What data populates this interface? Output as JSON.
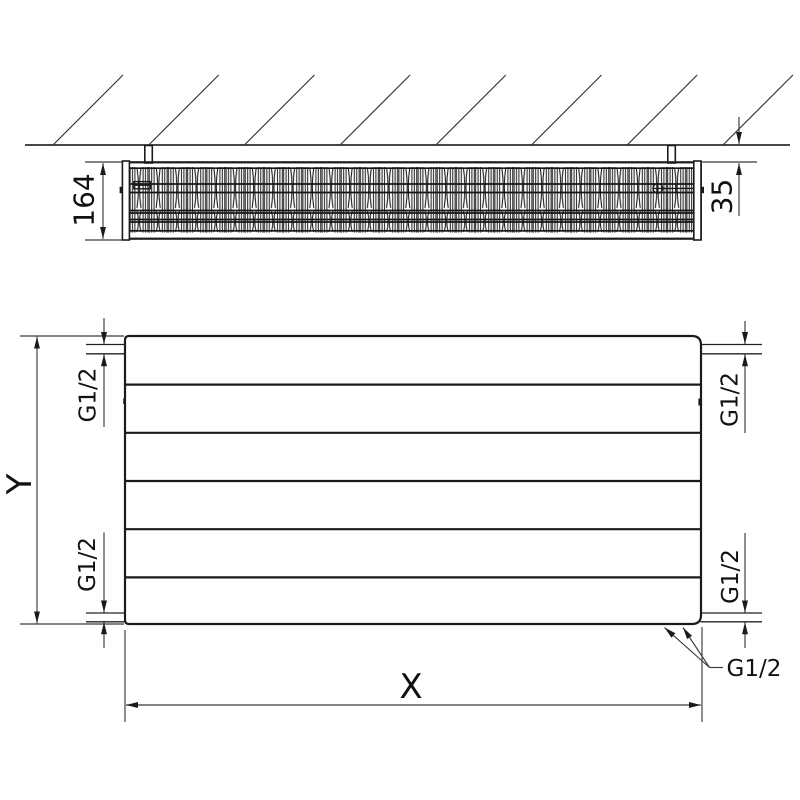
{
  "top_view": {
    "depth_dimension_label": "164",
    "wall_clearance_dimension_label": "35"
  },
  "front_view": {
    "height_dimension_label": "Y",
    "length_dimension_label": "X",
    "connection_top_left_label": "G1/2",
    "connection_top_right_label": "G1/2",
    "connection_bottom_left_label": "G1/2",
    "connection_bottom_right_label": "G1/2",
    "bottom_connections_leader_label": "G1/2"
  },
  "colors": {
    "object_line": "#1b1b1b",
    "dimension_line": "#3a3a3a",
    "background": "#ffffff"
  }
}
